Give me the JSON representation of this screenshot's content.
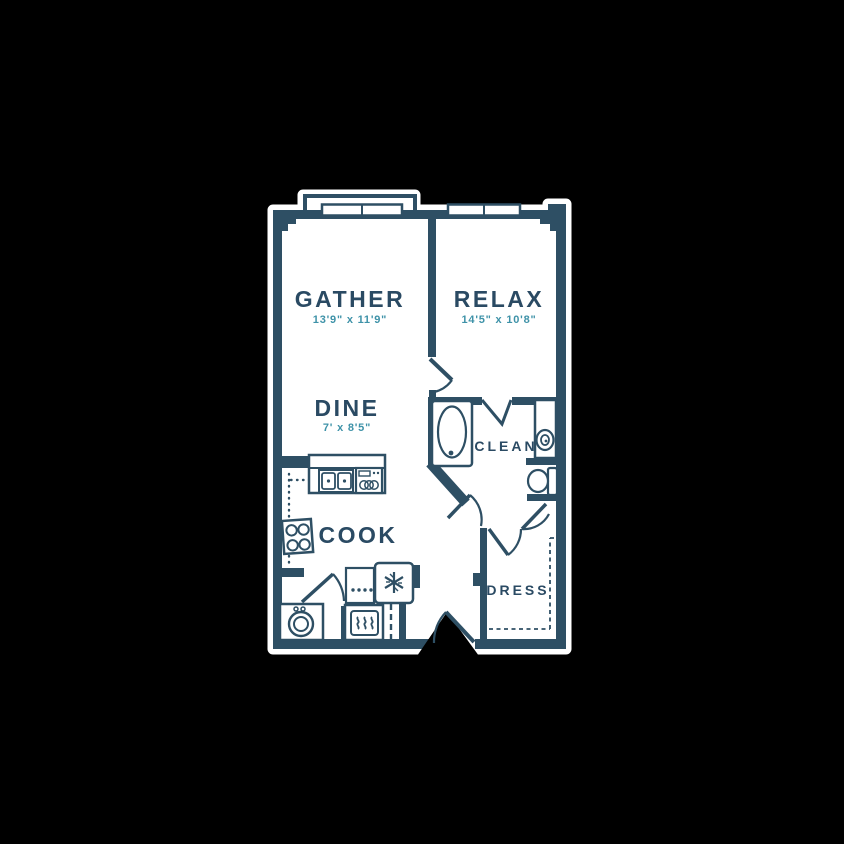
{
  "colors": {
    "background": "#000000",
    "wall": "#2E4F64",
    "floor": "#ffffff",
    "dimension_text": "#3E92A8",
    "room_text": "#2A4A63"
  },
  "rooms": {
    "gather": {
      "label": "GATHER",
      "dimensions": "13'9\" x 11'9\""
    },
    "relax": {
      "label": "RELAX",
      "dimensions": "14'5\" x 10'8\""
    },
    "dine": {
      "label": "DINE",
      "dimensions": "7' x 8'5\""
    },
    "cook": {
      "label": "COOK"
    },
    "clean": {
      "label": "CLEAN"
    },
    "dress": {
      "label": "DRESS"
    }
  },
  "fixtures": [
    "window",
    "window",
    "balcony-ledge",
    "bathtub",
    "vanity-sink",
    "toilet",
    "kitchen-counter",
    "kitchen-sink",
    "dishwasher",
    "cooktop",
    "refrigerator",
    "pantry",
    "oven",
    "washer-dryer",
    "entry-door",
    "closet-rod-dashes"
  ]
}
